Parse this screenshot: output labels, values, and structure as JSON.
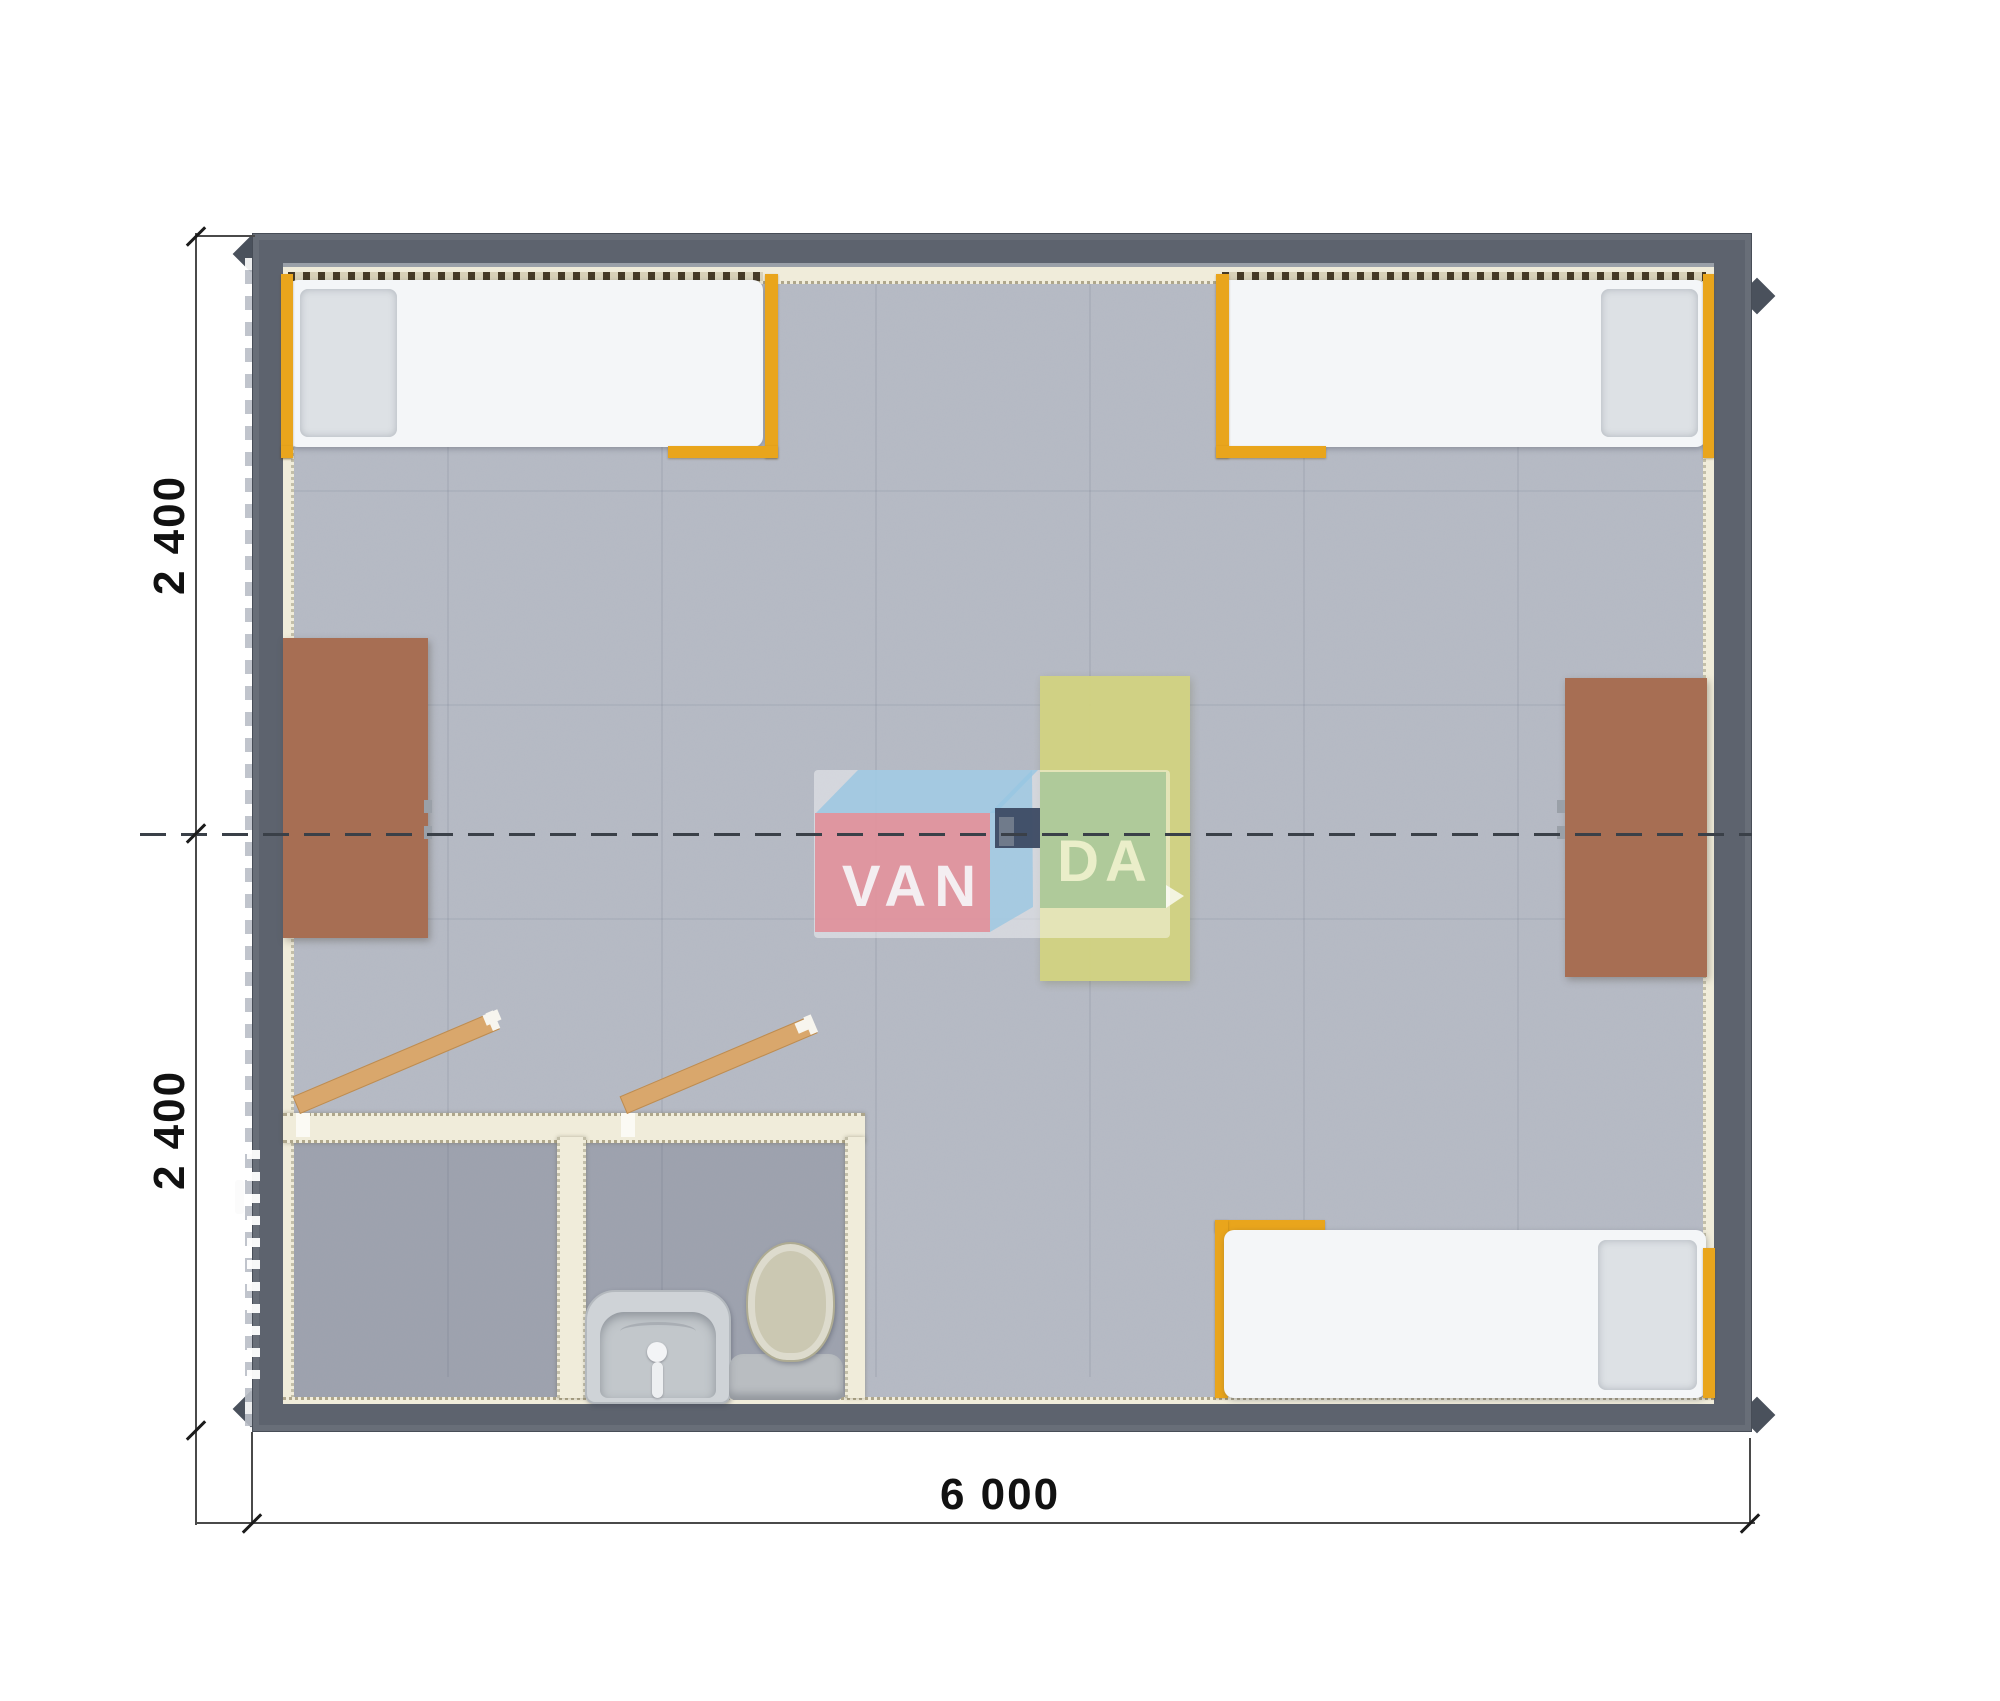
{
  "page": {
    "background": "#ffffff",
    "content": "top-down architectural render of a modular cabin floor plan"
  },
  "watermark": {
    "full": "VANDA",
    "brand_left": "VAN",
    "brand_right": "DA"
  },
  "dimensions": {
    "left_top": "2 400",
    "left_bottom": "2 400",
    "bottom": "6 000",
    "units": "mm"
  },
  "furniture": {
    "beds": [
      "bed-top-left",
      "bed-top-right",
      "bed-bottom-right"
    ],
    "desks": [
      "desk-left-wall",
      "desk-right-wall"
    ],
    "table": "center-table-yellow",
    "bathroom": [
      "shower-room-empty",
      "wc-room",
      "sink",
      "toilet"
    ],
    "doors": [
      "door-leaf-left-open",
      "door-leaf-right-open",
      "entry-door-on-left-wall"
    ]
  },
  "colors": {
    "wall": "#5d636e",
    "wall_dark": "#4a515c",
    "floor": "#b7bbc5",
    "floor_dark": "#a4a8b2",
    "cream": "#f0ecda",
    "tick": "#463a26",
    "orange": "#e9a51c",
    "mattress": "#f4f6f8",
    "pillow": "#dde1e5",
    "desk": "#a76e53",
    "table_yellow": "#d2d381",
    "wood": "#d9a76c",
    "logo_red": "#e18b95",
    "logo_blue": "#97c6e2",
    "logo_navy": "#3c4a63",
    "logo_green": "#6eaa78",
    "fixture": "#cfd3d7",
    "toilet_lid": "#cbc8b2",
    "dash": "#3a4048",
    "dim": "#1b1b1b"
  }
}
